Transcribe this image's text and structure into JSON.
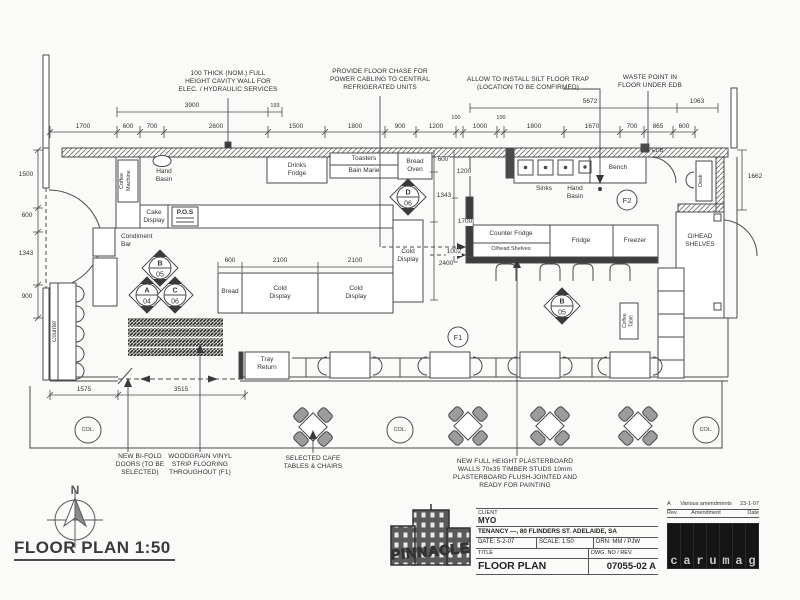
{
  "drawing": {
    "plan_title": "FLOOR PLAN 1:50",
    "north": "N"
  },
  "annotations": {
    "cavity_wall": "100 THICK (NOM.) FULL\nHEIGHT CAVITY WALL FOR\nELEC. / HYDRAULIC SERVICES",
    "floor_chase": "PROVIDE FLOOR CHASE FOR\nPOWER CABLING TO CENTRAL\nREFRIGERATED UNITS",
    "silt_trap": "ALLOW TO INSTALL SILT FLOOR TRAP\n(LOCATION TO BE CONFIRMED)",
    "waste_point": "WASTE POINT IN\nFLOOR UNDER EDB",
    "bifold": "NEW BI-FOLD\nDOORS (TO BE\nSELECTED)",
    "woodgrain": "WOODGRAIN VINYL\nSTRIP FLOORING\nTHROUGHOUT (F1)",
    "cafe": "SELECTED CAFE\nTABLES & CHAIRS",
    "plasterboard": "NEW FULL HEIGHT PLASTERBOARD\nWALLS 70x35 TIMBER STUDS 10mm\nPLASTERBOARD FLUSH-JOINTED AND\nREADY FOR PAINTING"
  },
  "labels": {
    "coffee_machine": "Coffee\nMachine",
    "hand_basin": "Hand\nBasin",
    "cake_display": "Cake\nDisplay",
    "pos": "P.O.S",
    "condiment_bar": "Condiment\nBar",
    "counter": "Counter",
    "drinks_fridge": "Drinks\nFridge",
    "toasters": "Toasters",
    "bain_marie": "Bain Marie",
    "bread_oven": "Bread\nOven",
    "sinks": "Sinks",
    "hand_basin2": "Hand\nBasin",
    "bench": "Bench",
    "edb": "EDB",
    "desk": "Desk",
    "counter_fridge": "Counter Fridge",
    "ohead_shelves_small": "O/head Shelves",
    "fridge": "Fridge",
    "freezer": "Freezer",
    "ohead_shelves": "O/HEAD\nSHELVES",
    "cold_display_v": "Cold\nDisplay",
    "bread": "Bread",
    "cold_display_1": "Cold\nDisplay",
    "cold_display_2": "Cold\nDisplay",
    "tray_return": "Tray\nReturn",
    "coffee_table": "Coffee\nTable",
    "col": "COL."
  },
  "markers": {
    "b05": {
      "letter": "B",
      "num": "05"
    },
    "a04": {
      "letter": "A",
      "num": "04"
    },
    "c06": {
      "letter": "C",
      "num": "06"
    },
    "d06": {
      "letter": "D",
      "num": "06"
    },
    "b05b": {
      "letter": "B",
      "num": "05"
    },
    "f1": "F1",
    "f2": "F2"
  },
  "dims": {
    "upper": [
      "3900",
      "193",
      "5672",
      "1063"
    ],
    "top": [
      "1700",
      "600",
      "700",
      "2600",
      "1500",
      "1800",
      "900",
      "1200",
      "100",
      "1000",
      "100",
      "1800",
      "1670",
      "700",
      "865",
      "600"
    ],
    "left": [
      "1500",
      "600",
      "1343",
      "900"
    ],
    "right": [
      "1662"
    ],
    "inner_a": [
      "600",
      "1343",
      "2400"
    ],
    "inner_b": [
      "1200",
      "1700",
      "1002"
    ],
    "mid": [
      "600",
      "2100",
      "2100"
    ],
    "bottom": [
      "1575",
      "3515"
    ]
  },
  "titleblock": {
    "client_label": "CLIENT",
    "client": "MYO",
    "tenancy": "TENANCY —, 80 FLINDERS ST. ADELAIDE, SA",
    "date_label": "DATE:",
    "date": "5-2-07",
    "scale_label": "SCALE:",
    "scale": "1:50",
    "drn_label": "DRN:",
    "drn": "MM / PJW",
    "title_label": "TITLE",
    "dwg_label": "DWG. NO / REV.",
    "title": "FLOOR PLAN",
    "dwg_no": "07055-02 A",
    "rev": {
      "rev": "A",
      "amendment": "Various amendments",
      "date": "23-1-07",
      "rev_h": "Rev.",
      "amendment_h": "Amendment",
      "date_h": "Date"
    }
  },
  "logo": {
    "name": "PINNACLE"
  },
  "watermark": {
    "letters": [
      "c",
      "a",
      "r",
      "u",
      "m",
      "a",
      "g"
    ]
  }
}
